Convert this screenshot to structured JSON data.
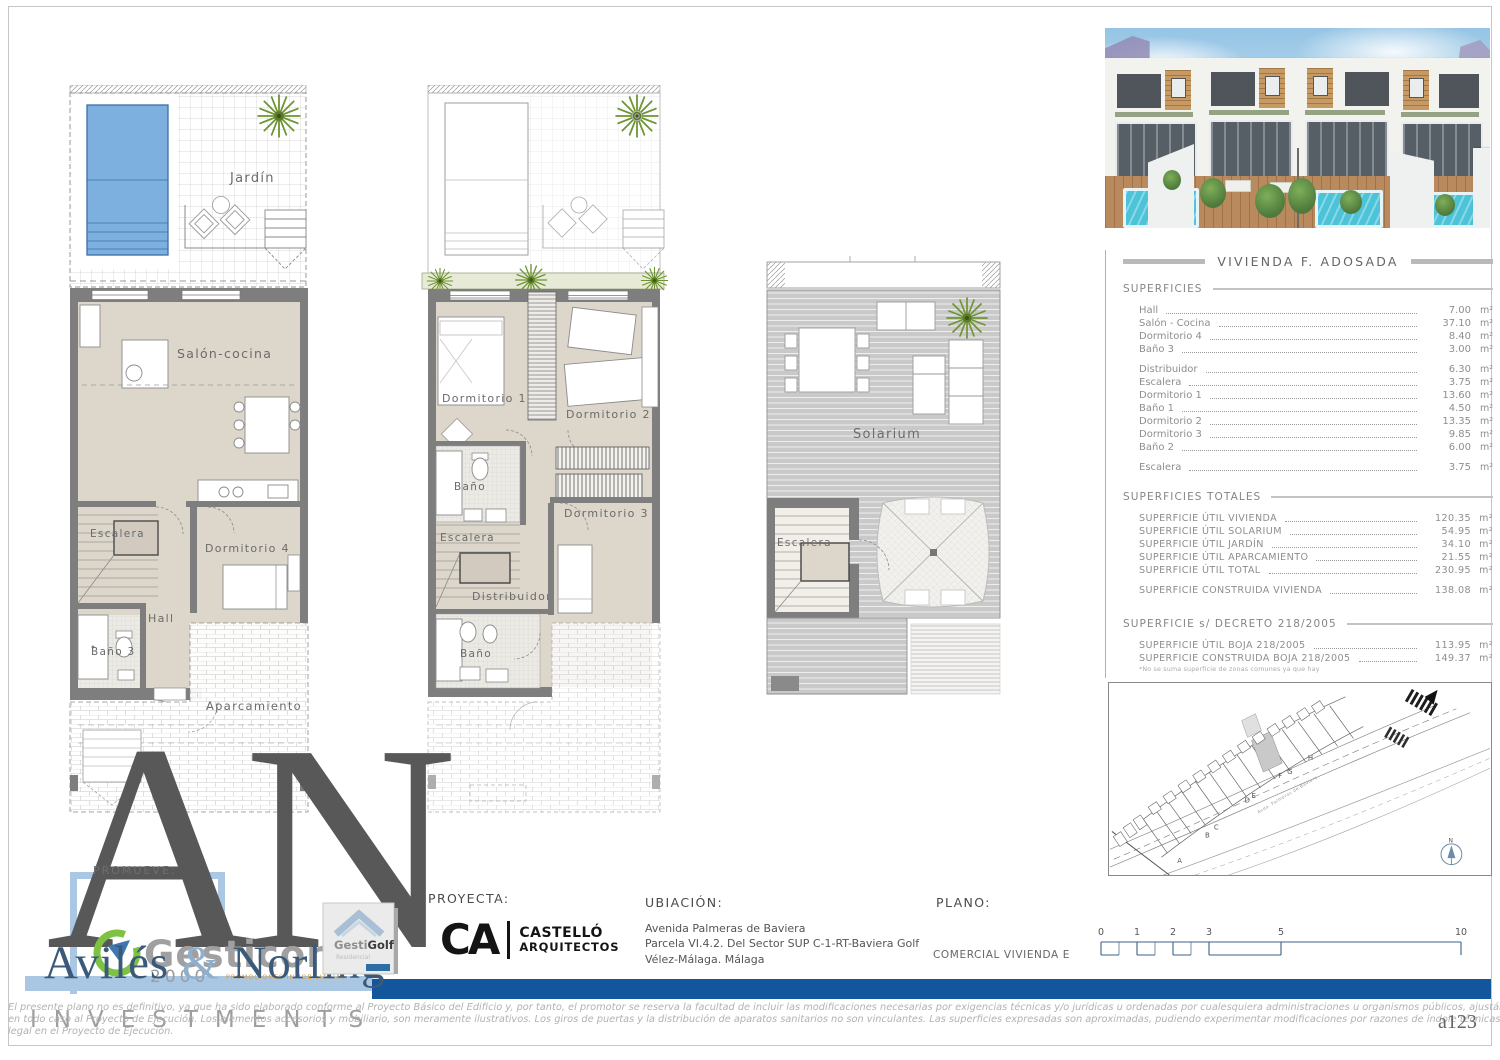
{
  "plans": {
    "ground": {
      "jardin": "Jardín",
      "salon_cocina": "Salón-cocina",
      "escalera": "Escalera",
      "dormitorio4": "Dormitorio 4",
      "hall": "Hall",
      "bano3": "Baño 3",
      "aparcamiento": "Aparcamiento"
    },
    "first": {
      "dormitorio1": "Dormitorio 1",
      "dormitorio2": "Dormitorio 2",
      "bano_sup": "Baño",
      "escalera": "Escalera",
      "distribuidor": "Distribuidor",
      "dormitorio3": "Dormitorio 3",
      "bano_inf": "Baño"
    },
    "roof": {
      "solarium": "Solarium",
      "escalera": "Escalera"
    }
  },
  "panel": {
    "title": "VIVIENDA F. ADOSADA",
    "unit": "m²",
    "superficies": {
      "header": "SUPERFICIES",
      "rows": [
        {
          "label": "Hall",
          "value": "7.00"
        },
        {
          "label": "Salón - Cocina",
          "value": "37.10"
        },
        {
          "label": "Dormitorio 4",
          "value": "8.40"
        },
        {
          "label": "Baño 3",
          "value": "3.00"
        },
        {
          "label": "Distribuidor",
          "value": "6.30"
        },
        {
          "label": "Escalera",
          "value": "3.75"
        },
        {
          "label": "Dormitorio 1",
          "value": "13.60"
        },
        {
          "label": "Baño 1",
          "value": "4.50"
        },
        {
          "label": "Dormitorio 2",
          "value": "13.35"
        },
        {
          "label": "Dormitorio 3",
          "value": "9.85"
        },
        {
          "label": "Baño 2",
          "value": "6.00"
        },
        {
          "label": "Escalera",
          "value": "3.75"
        }
      ]
    },
    "totales": {
      "header": "SUPERFICIES TOTALES",
      "rows": [
        {
          "label": "SUPERFICIE ÚTIL VIVIENDA",
          "value": "120.35"
        },
        {
          "label": "SUPERFICIE ÚTIL SOLARIUM",
          "value": "54.95"
        },
        {
          "label": "SUPERFICIE ÚTIL JARDÍN",
          "value": "34.10"
        },
        {
          "label": "SUPERFICIE ÚTIL APARCAMIENTO",
          "value": "21.55"
        },
        {
          "label": "SUPERFICIE ÚTIL TOTAL",
          "value": "230.95"
        },
        {
          "label": "SUPERFICIE CONSTRUIDA VIVIENDA",
          "value": "138.08"
        }
      ]
    },
    "decreto": {
      "header": "SUPERFICIE s/ DECRETO 218/2005",
      "rows": [
        {
          "label": "SUPERFICIE ÚTIL BOJA 218/2005",
          "value": "113.95"
        },
        {
          "label": "SUPERFICIE CONSTRUIDA BOJA 218/2005",
          "value": "149.37"
        }
      ],
      "footnote": "*No se suma superficie de zonas comunes ya que hay"
    }
  },
  "siteplan": {
    "letters": [
      "A",
      "B",
      "C",
      "D",
      "E",
      "F",
      "G",
      "H"
    ],
    "street": "Avda. Palmeras de Baviera",
    "north_label": "N"
  },
  "titleblock": {
    "proyecta_label": "PROYECTA:",
    "architect": {
      "monogram": "CA",
      "line1": "CASTELLÓ",
      "line2": "ARQUITECTOS"
    },
    "ubicacion_label": "UBIACIÓN:",
    "address1": "Avenida Palmeras de Baviera",
    "address2": "Parcela VI.4.2. Del Sector SUP C-1-RT-Baviera Golf",
    "address3": "Vélez-Málaga. Málaga",
    "plano_label": "PLANO:",
    "plano_value": "COMERCIAL VIVIENDA E",
    "scale_ticks": [
      "0",
      "1",
      "2",
      "3",
      "5",
      "10"
    ]
  },
  "branding": {
    "promueve": "PROMUEVE:",
    "monogram": "AN",
    "gesticor_name": "Gesticor",
    "gesticor_year": "2000",
    "gesticor_tagline": "PROMOCIONES INMOBILIARIAS",
    "aviles_1": "Avilés",
    "aviles_amp": "&",
    "aviles_2": "Norling",
    "investments": "INVESTMENTS",
    "gestigolf_a": "Gesti",
    "gestigolf_b": "Golf",
    "gestigolf_sub": "Residencial"
  },
  "footer": {
    "line1": "El presente plano no es definitivo, ya que ha sido elaborado conforme al Proyecto Básico del Edificio y, por tanto, el promotor se reserva la facultad de incluir las modificaciones necesarias por exigencias técnicas y/o jurídicas u ordenadas por cualesquiera administraciones u organismos públicos, ajustándolo",
    "line2": "en todo caso al Proyecto de Ejecución. Los elementos accesorios y mobiliario, son meramente ilustrativos. Los giros de puertas y la distribución de aparatos sanitarios no son vinculantes. Las superficies expresadas son aproximadas, pudiendo experimentar modificaciones por razones de índole técnicas y/o",
    "line3": "legal en el Proyecto de Ejecución.",
    "sheet_code": "a123"
  },
  "colors": {
    "brand_blue": "#14569b",
    "light_blue": "#a9c6e3",
    "pool_blue": "#7db0de",
    "wall_gray": "#7e7e7e",
    "floor_beige": "#ddd6cb",
    "plant_green": "#6e9433"
  }
}
